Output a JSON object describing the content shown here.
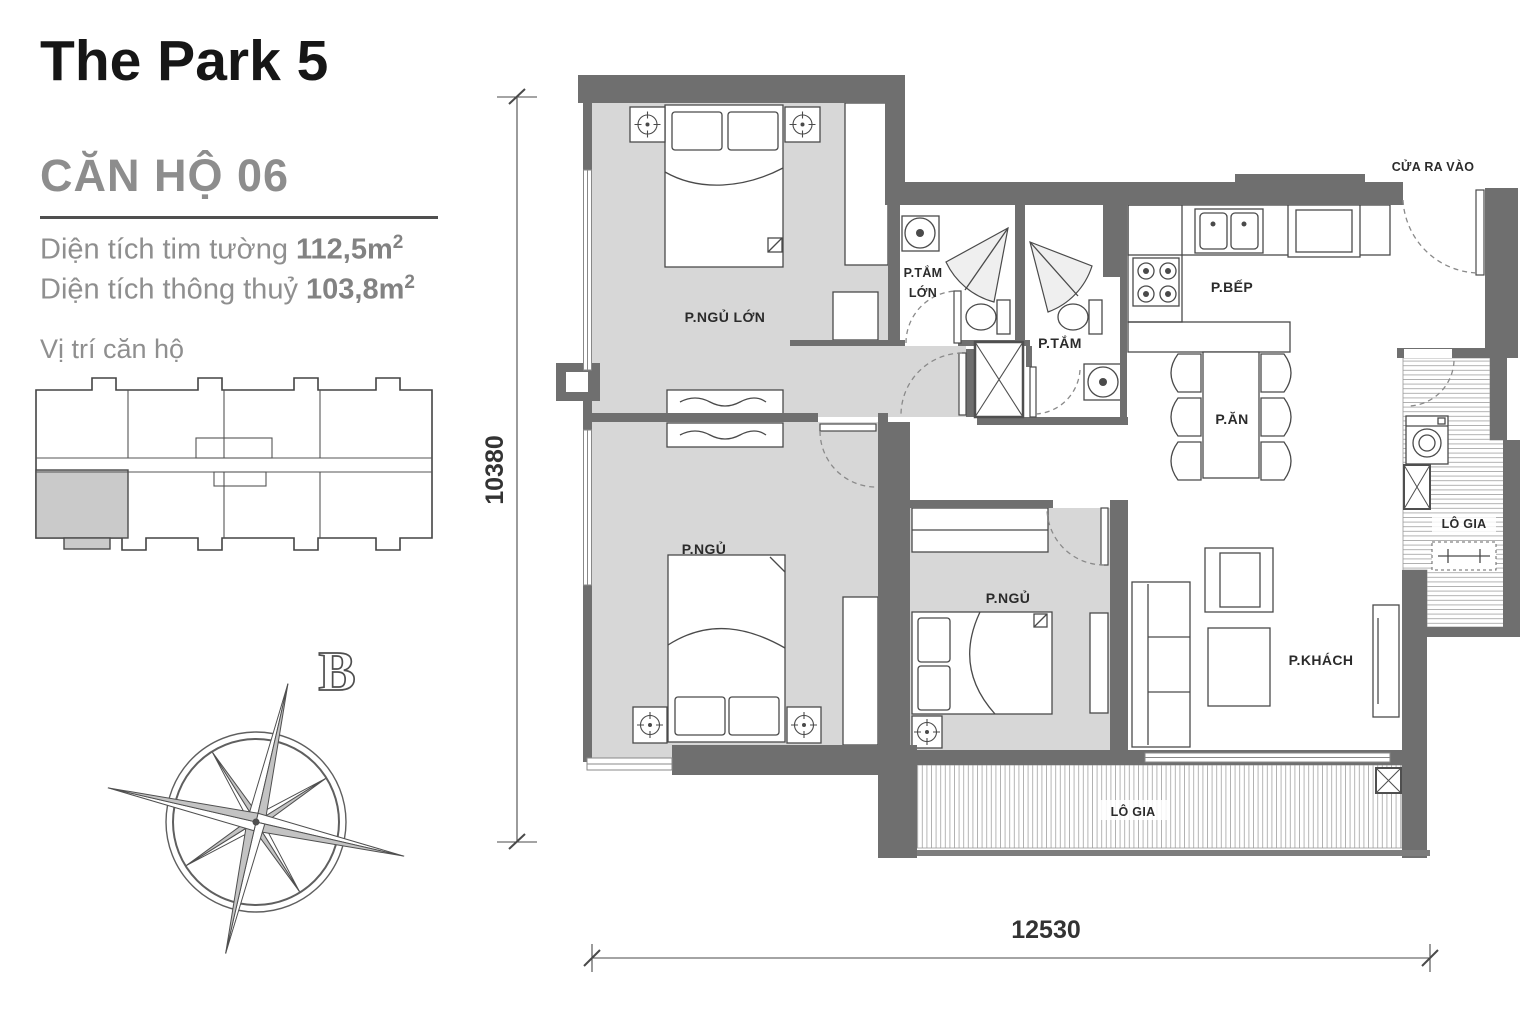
{
  "header": {
    "title": "The Park 5",
    "unit_name": "CĂN HỘ 06",
    "area1_label": "Diện tích tim tường ",
    "area1_value": "112,5m",
    "area1_sup": "2",
    "area2_label": "Diện tích thông thuỷ ",
    "area2_value": "103,8m",
    "area2_sup": "2",
    "location_title": "Vị trí căn hộ"
  },
  "compass": {
    "north_label": "B"
  },
  "floorplan": {
    "entrance_label": "CỬA RA VÀO",
    "dim_height": "10380",
    "dim_width": "12530",
    "rooms": {
      "master_bedroom": "P.NGỦ LỚN",
      "master_bath_line1": "P.TẮM",
      "master_bath_line2": "LỚN",
      "bath2": "P.TẮM",
      "kitchen": "P.BẾP",
      "dining": "P.ĂN",
      "bedroom2": "P.NGỦ",
      "bedroom3": "P.NGỦ",
      "living": "P.KHÁCH",
      "loggia_side": "LÔ GIA",
      "loggia_bottom": "LÔ GIA"
    }
  },
  "colors": {
    "wall": "#6f6f6f",
    "floor": "#d7d7d7",
    "unit_highlight": "#cacaca",
    "label_dark": "#2b2b2b",
    "text_muted": "#8f8f8f"
  }
}
